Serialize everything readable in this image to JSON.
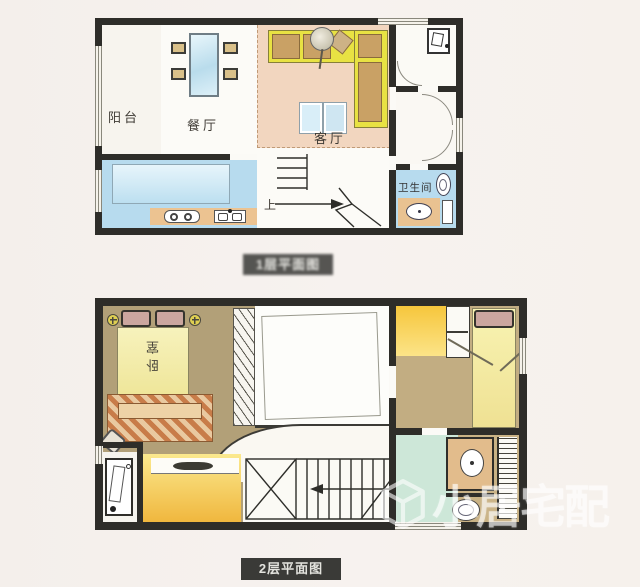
{
  "page": {
    "background": "#f6f1ee",
    "type": "two-storey apartment floor plan"
  },
  "floor1": {
    "caption": "1层平面图",
    "labels": {
      "balcony": "阳台",
      "dining": "餐厅",
      "living": "客厅",
      "bathroom": "卫生间",
      "stairs_up": "上"
    }
  },
  "floor2": {
    "caption": "2层平面图",
    "labels": {
      "bedroom": "卧室"
    }
  },
  "watermark": {
    "text": "小居宅配",
    "icon": "cube-logo"
  },
  "icons": {
    "washing-machine": "rect with drum",
    "toilet": "oval bowl",
    "sink": "oval basin",
    "stove": "two burners",
    "bedside-lamp": "circle with cross",
    "stairs-arrow": "direction arrow",
    "cube-logo": "isometric cube outline"
  },
  "colors": {
    "wall": "#2e2d29",
    "living_floor": "#f2d6bf",
    "kitchen_floor": "#b7dbee",
    "bathroom1_floor": "#b7dbee",
    "sofa_yellow": "#e8e243",
    "cushion_tan": "#c9a165",
    "bedroom_floor": "#b2a078",
    "bed_yellow": "#f4efae",
    "desk_yellow": "#f0b73e",
    "bathroom2_floor": "#cde7d8",
    "caption_bg": "#3a3a37"
  }
}
